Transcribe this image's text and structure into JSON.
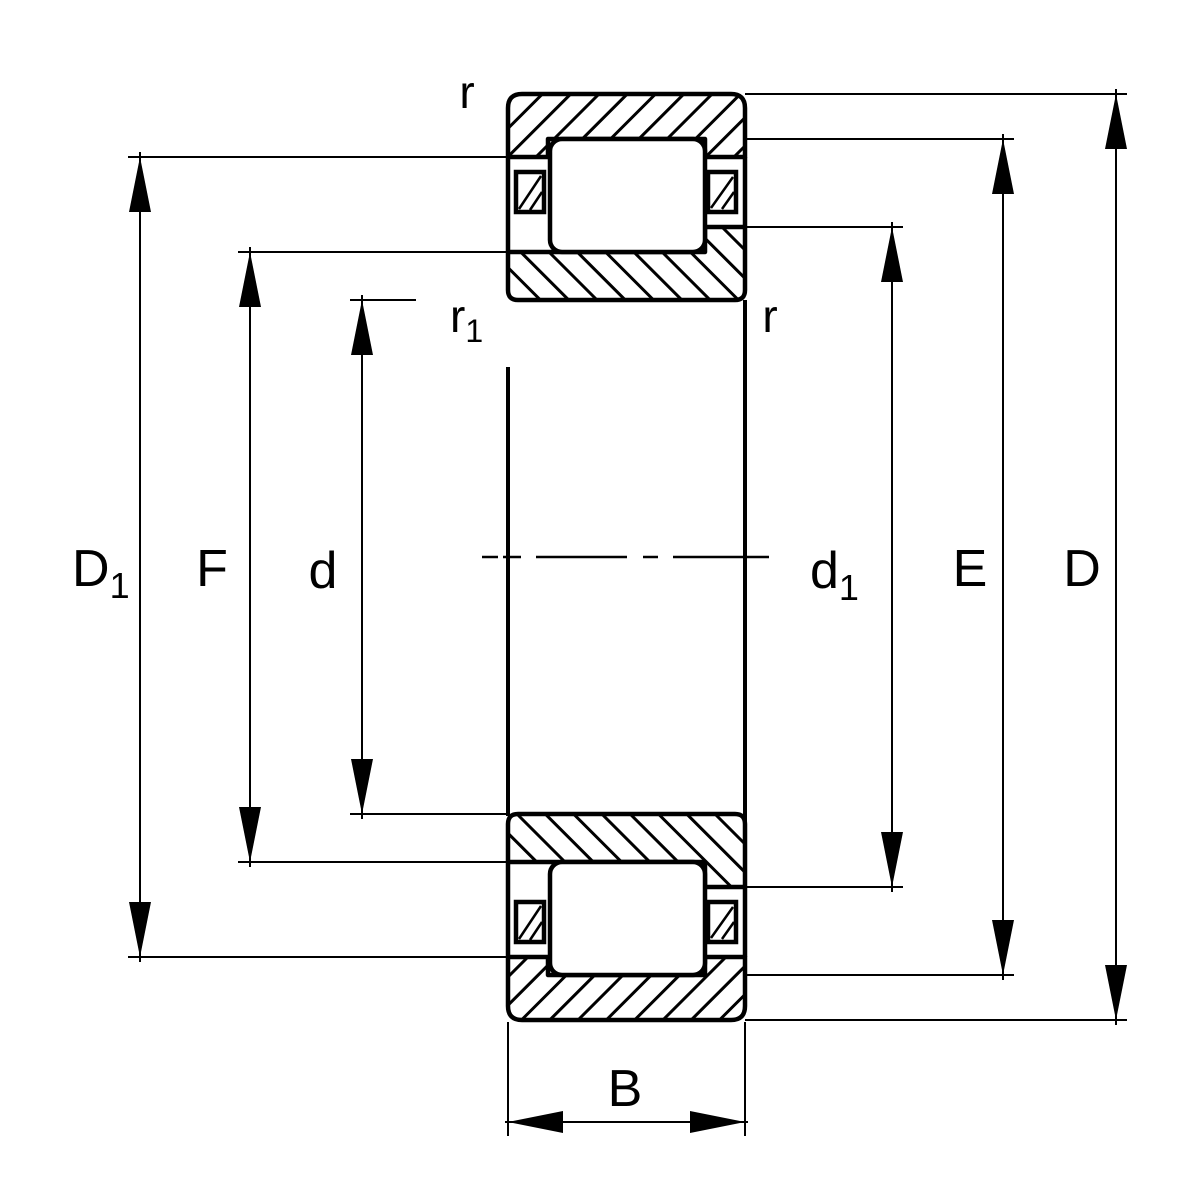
{
  "colors": {
    "background": "#ffffff",
    "line": "#000000"
  },
  "labels": {
    "D1": {
      "base": "D",
      "sub": "1"
    },
    "F": {
      "base": "F",
      "sub": ""
    },
    "d": {
      "base": "d",
      "sub": ""
    },
    "r_top": {
      "base": "r",
      "sub": ""
    },
    "r1": {
      "base": "r",
      "sub": "1"
    },
    "d1": {
      "base": "d",
      "sub": "1"
    },
    "r_right": {
      "base": "r",
      "sub": ""
    },
    "E": {
      "base": "E",
      "sub": ""
    },
    "D": {
      "base": "D",
      "sub": ""
    },
    "B": {
      "base": "B",
      "sub": ""
    }
  }
}
